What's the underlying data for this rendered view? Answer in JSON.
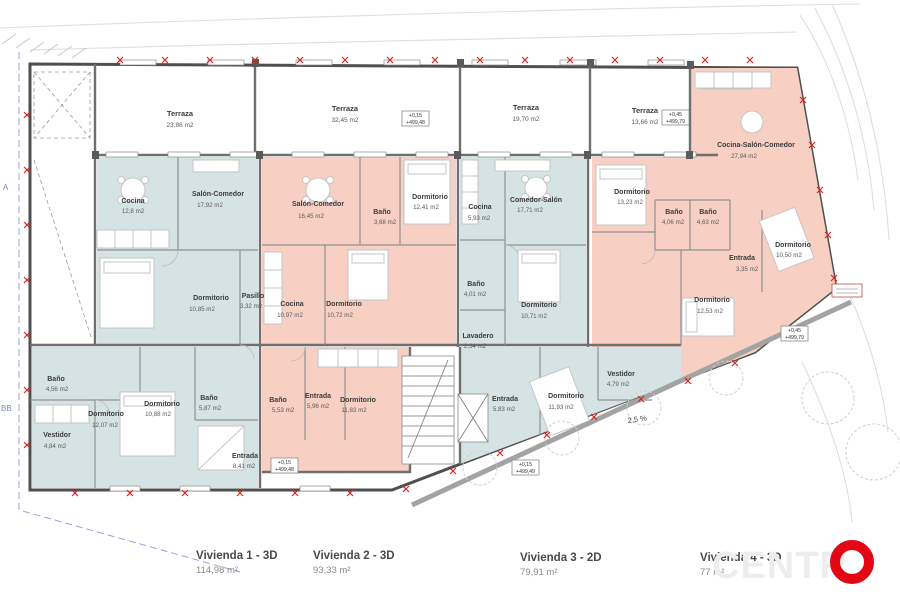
{
  "document": {
    "type": "architectural-floor-plan"
  },
  "colors": {
    "unit_blue": "#d6e3e5",
    "unit_pink": "#f7cfc3",
    "wall_gray": "#4f4f4f",
    "survey_red": "#d6261f",
    "brand_red": "#e30613",
    "boundary_blue": "#9aa4dc"
  },
  "terraces": [
    {
      "name": "Terraza",
      "area": "23,86 m2"
    },
    {
      "name": "Terraza",
      "area": "32,45 m2"
    },
    {
      "name": "Terraza",
      "area": "19,70 m2"
    },
    {
      "name": "Terraza",
      "area": "13,66 m2"
    }
  ],
  "rooms": [
    {
      "name": "Cocina",
      "area": "12,8 m2"
    },
    {
      "name": "Salón-Comedor",
      "area": "17,92 m2"
    },
    {
      "name": "Dormitorio",
      "area": "10,85 m2"
    },
    {
      "name": "Pasillo",
      "area": "3,32 m2"
    },
    {
      "name": "Baño",
      "area": "4,56 m2"
    },
    {
      "name": "Dormitorio",
      "area": "12,07 m2"
    },
    {
      "name": "Vestidor",
      "area": "4,84 m2"
    },
    {
      "name": "Dormitorio",
      "area": "10,88 m2"
    },
    {
      "name": "Baño",
      "area": "5,87 m2"
    },
    {
      "name": "Entrada",
      "area": "8,41 m2"
    },
    {
      "name": "Salón-Comedor",
      "area": "16,45 m2"
    },
    {
      "name": "Baño",
      "area": "3,68 m2"
    },
    {
      "name": "Dormitorio",
      "area": "12,41 m2"
    },
    {
      "name": "Cocina",
      "area": "10,97 m2"
    },
    {
      "name": "Dormitorio",
      "area": "10,72 m2"
    },
    {
      "name": "Baño",
      "area": "5,53 m2"
    },
    {
      "name": "Entrada",
      "area": "5,96 m2"
    },
    {
      "name": "Dormitorio",
      "area": "11,83 m2"
    },
    {
      "name": "Cocina",
      "area": "5,93 m2"
    },
    {
      "name": "Comedor-Salón",
      "area": "17,71 m2"
    },
    {
      "name": "Baño",
      "area": "4,01 m2"
    },
    {
      "name": "Lavadero",
      "area": "2,34 m2"
    },
    {
      "name": "Dormitorio",
      "area": "10,71 m2"
    },
    {
      "name": "Entrada",
      "area": "5,83 m2"
    },
    {
      "name": "Dormitorio",
      "area": "11,93 m2"
    },
    {
      "name": "Vestidor",
      "area": "4,79 m2"
    },
    {
      "name": "Dormitorio",
      "area": "13,23 m2"
    },
    {
      "name": "Cocina-Salón-Comedor",
      "area": "27,94 m2"
    },
    {
      "name": "Baño",
      "area": "4,06 m2"
    },
    {
      "name": "Baño",
      "area": "4,63 m2"
    },
    {
      "name": "Dormitorio",
      "area": "10,50 m2"
    },
    {
      "name": "Entrada",
      "area": "3,35 m2"
    },
    {
      "name": "Dormitorio",
      "area": "12,53 m2"
    }
  ],
  "elevation_markers": [
    {
      "l1": "+0,15",
      "l2": "+499,48"
    },
    {
      "l1": "+0,45",
      "l2": "+499,79"
    },
    {
      "l1": "+0,15",
      "l2": "+499,48"
    },
    {
      "l1": "+0,15",
      "l2": "+499,49"
    },
    {
      "l1": "+0,45",
      "l2": "+499,79"
    }
  ],
  "slope_label": "2,5 %",
  "boundary_labels": {
    "a": "A",
    "bb": "BB"
  },
  "legend": [
    {
      "label": "Vivienda 1 - 3D",
      "area": "114,98 m²"
    },
    {
      "label": "Vivienda 2 - 3D",
      "area": "93,33 m²"
    },
    {
      "label": "Vivienda 3 - 2D",
      "area": "79,91 m²"
    },
    {
      "label": "Vivienda 4 - 3D",
      "area": "77 m²"
    }
  ],
  "logo": {
    "letters": "CENTR",
    "o": "O"
  }
}
